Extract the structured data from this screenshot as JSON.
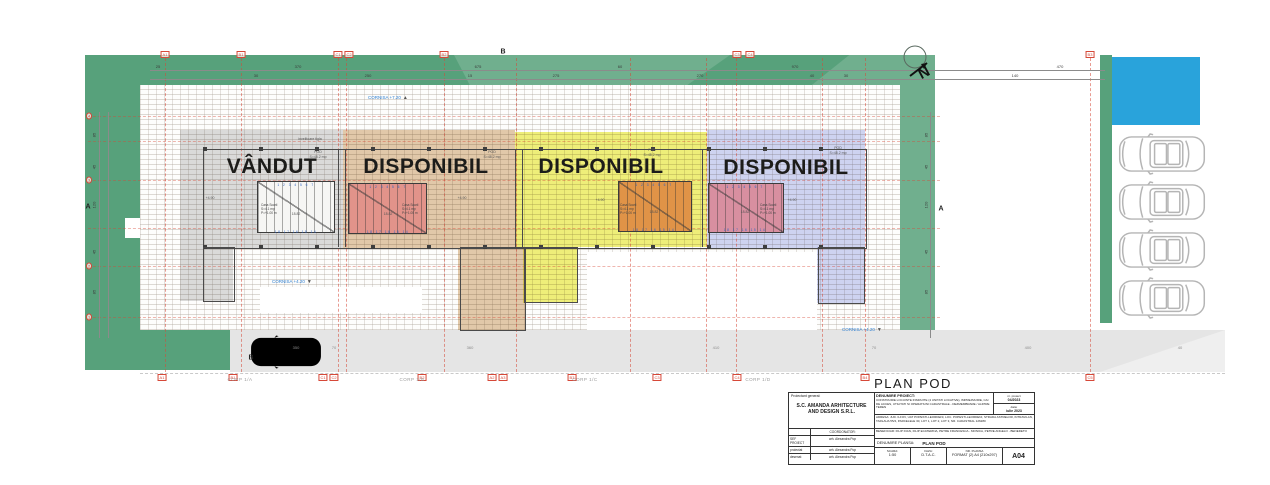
{
  "title": "PLAN POD",
  "north_letter": "N",
  "plan": {
    "unit_labels": [
      {
        "t": "VÂNDUT",
        "x": 272,
        "y": 155
      },
      {
        "t": "DISPONIBIL",
        "x": 426,
        "y": 155
      },
      {
        "t": "DISPONIBIL",
        "x": 601,
        "y": 155
      },
      {
        "t": "DISPONIBIL",
        "x": 786,
        "y": 156
      }
    ],
    "cornisa": [
      {
        "text": "CORNISA +7.20",
        "tri": "▲",
        "x": 368,
        "y": 95
      },
      {
        "text": "CORNISA +4.20",
        "tri": "▼",
        "x": 272,
        "y": 279
      },
      {
        "text": "CORNISA +4.20",
        "tri": "▼",
        "x": 842,
        "y": 327
      }
    ],
    "grid_top": [
      {
        "label": "A1",
        "x": 165
      },
      {
        "label": "B1",
        "x": 241
      },
      {
        "label": "C1",
        "x": 338
      },
      {
        "label": "C2",
        "x": 349
      },
      {
        "label": "B2",
        "x": 444
      },
      {
        "label": "C3",
        "x": 737
      },
      {
        "label": "C4",
        "x": 750
      },
      {
        "label": "B3",
        "x": 1090
      }
    ],
    "grid_bottom": [
      {
        "label": "A1",
        "x": 162
      },
      {
        "label": "B1",
        "x": 233
      },
      {
        "label": "C1",
        "x": 323
      },
      {
        "label": "C2",
        "x": 334
      },
      {
        "label": "B2",
        "x": 422
      },
      {
        "label": "A2",
        "x": 492
      },
      {
        "label": "A3",
        "x": 503
      },
      {
        "label": "B3",
        "x": 572
      },
      {
        "label": "C3",
        "x": 657
      },
      {
        "label": "C4",
        "x": 737
      },
      {
        "label": "B4",
        "x": 865
      },
      {
        "label": "C5",
        "x": 1090
      }
    ],
    "grid_left": [
      {
        "label": "4",
        "y": 116
      },
      {
        "label": "3",
        "y": 180
      },
      {
        "label": "2",
        "y": 266
      },
      {
        "label": "1",
        "y": 317
      }
    ],
    "vlines": [
      165,
      241,
      338,
      346,
      444,
      516,
      630,
      706,
      736,
      822,
      865,
      1090
    ],
    "hlines": [
      116,
      141,
      180,
      228,
      266,
      317
    ],
    "dims_row1": [
      {
        "t": "25",
        "x": 158
      },
      {
        "t": "370",
        "x": 298
      },
      {
        "t": "675",
        "x": 478
      },
      {
        "t": "60",
        "x": 620
      },
      {
        "t": "970",
        "x": 795
      },
      {
        "t": "470",
        "x": 1060
      }
    ],
    "dims_row2": [
      {
        "t": "30",
        "x": 256
      },
      {
        "t": "250",
        "x": 368
      },
      {
        "t": "15",
        "x": 470
      },
      {
        "t": "275",
        "x": 556
      },
      {
        "t": "270",
        "x": 700
      },
      {
        "t": "40",
        "x": 812
      },
      {
        "t": "30",
        "x": 846
      },
      {
        "t": "140",
        "x": 1015
      }
    ],
    "dims_left": [
      {
        "t": "85",
        "y": 135
      },
      {
        "t": "45",
        "y": 167
      },
      {
        "t": "120",
        "y": 205
      },
      {
        "t": "45",
        "y": 252
      },
      {
        "t": "85",
        "y": 292
      }
    ],
    "dims_right": [
      {
        "t": "85",
        "y": 135
      },
      {
        "t": "45",
        "y": 167
      },
      {
        "t": "120",
        "y": 205
      },
      {
        "t": "45",
        "y": 252
      },
      {
        "t": "85",
        "y": 292
      }
    ],
    "road_dims": [
      {
        "t": "350",
        "x": 296
      },
      {
        "t": "70",
        "x": 334
      },
      {
        "t": "360",
        "x": 470
      },
      {
        "t": "410",
        "x": 716
      },
      {
        "t": "70",
        "x": 874
      },
      {
        "t": "400",
        "x": 1028
      },
      {
        "t": "40",
        "x": 1180
      }
    ],
    "corp_labels": [
      {
        "t": "CORP 1/A",
        "x": 240
      },
      {
        "t": "CORP 1/B",
        "x": 412
      },
      {
        "t": "CORP 1/C",
        "x": 585
      },
      {
        "t": "CORP 1/D",
        "x": 758
      }
    ],
    "section_marks": [
      {
        "t": "A",
        "x": 88,
        "y": 207
      },
      {
        "t": "A",
        "x": 941,
        "y": 209
      },
      {
        "t": "B",
        "x": 503,
        "y": 52
      },
      {
        "t": "B",
        "x": 251,
        "y": 358
      }
    ],
    "stair_text": {
      "l1": "Casa Scarii",
      "l2": "S=4.1 mp",
      "l3": "P=+1.00 m"
    },
    "stair_caps": [
      {
        "x": 261,
        "y": 203
      },
      {
        "x": 402,
        "y": 203
      },
      {
        "x": 620,
        "y": 203
      },
      {
        "x": 760,
        "y": 203
      }
    ],
    "tiny_texts": [
      {
        "t": "POD",
        "x": 318,
        "y": 150
      },
      {
        "t": "S=48.2 mp",
        "x": 318,
        "y": 155
      },
      {
        "t": "POD",
        "x": 492,
        "y": 150
      },
      {
        "t": "S=48.2 mp",
        "x": 492,
        "y": 155
      },
      {
        "t": "POD",
        "x": 652,
        "y": 148
      },
      {
        "t": "S=48.2 mp",
        "x": 652,
        "y": 153
      },
      {
        "t": "POD",
        "x": 838,
        "y": 146
      },
      {
        "t": "S=48.2 mp",
        "x": 838,
        "y": 151
      },
      {
        "t": "+4.90",
        "x": 210,
        "y": 196
      },
      {
        "t": "+4.90",
        "x": 462,
        "y": 196
      },
      {
        "t": "+4.90",
        "x": 600,
        "y": 198
      },
      {
        "t": "+4.90",
        "x": 792,
        "y": 198
      },
      {
        "t": "18.82",
        "x": 296,
        "y": 212
      },
      {
        "t": "18.82",
        "x": 388,
        "y": 212
      },
      {
        "t": "18.82",
        "x": 654,
        "y": 210
      },
      {
        "t": "18.82",
        "x": 745,
        "y": 210
      },
      {
        "t": "invelitoare tigla",
        "x": 310,
        "y": 137
      }
    ],
    "steps": [
      {
        "t": "1 2 3 4 5 6 7",
        "x": 296,
        "y": 183
      },
      {
        "t": "1 2 3 4 5 6 7",
        "x": 388,
        "y": 185
      },
      {
        "t": "1 2 3 4 5 6 7",
        "x": 654,
        "y": 183
      },
      {
        "t": "1 2 3 4 5 6 7",
        "x": 745,
        "y": 185
      },
      {
        "t": "18 17 16 15 14",
        "x": 296,
        "y": 230
      },
      {
        "t": "18 17 16 15 14",
        "x": 388,
        "y": 230
      },
      {
        "t": "18 17 16 15 14",
        "x": 654,
        "y": 228
      },
      {
        "t": "18 17 16 15 14",
        "x": 745,
        "y": 228
      }
    ],
    "cars_y": [
      131,
      179,
      227,
      275
    ]
  },
  "titleblock": {
    "general_label": "Proiectant general:",
    "firm": "S.C. AMANDA ARHITECTURE AND DESIGN S.R.L.",
    "coordinator_label": "COORDONATOR:",
    "sef_label": "SEF PROIECT",
    "sef_name": "arh. Alexandra Pop",
    "rows": [
      {
        "role": "proiectat",
        "name": "arh. Alexandra Pop"
      },
      {
        "role": "desenat",
        "name": "arh. Alexandra Pop"
      }
    ],
    "project_label": "DENUMIRE PROIECT:",
    "project_lines": "CONSTRUIRE LOCUINTE INSIRUITE (4 UNITATI LOCATIVE), IMPREJMUIRE, CAI DE ACCES, UTILITATI SI OPERATIUNI CADASTRALE - DEZMEMBRARE / ALIPIRE TEREN",
    "nr_label": "nr. proiect",
    "nr_value": "04/2023",
    "date_label": "data:",
    "date_value": "iulie 2023",
    "address": "ADRESA: JUD. ILFOV, UAT POPESTI-LEORDENI, LOC. POPESTI-LEORDENI, STRADA ASTRELOR, INTRAVILAN, TARLAUA 55/4, PARCELELE 30, LOT 1, LOT 2, LOT 3, NR. CADASTRAL 126280",
    "beneficiary": "BENEFICIAR: FILIP IOAN, FILIP ECATERINA, PETRE FRANCESCA - MONICA, PETRE ANGELO - BENEDETO",
    "plansa_label": "DENUMIRE PLANSA:",
    "plansa_value": "PLAN POD",
    "scara_label": "SCARA:",
    "scara_value": "1:50",
    "faza_label": "FAZA:",
    "faza_value": "D.T.A.C.",
    "nrplansa_label": "NR. PLANSA",
    "format_value": "FORMAT (2) A4 (210x297)",
    "sheet": "A04"
  }
}
